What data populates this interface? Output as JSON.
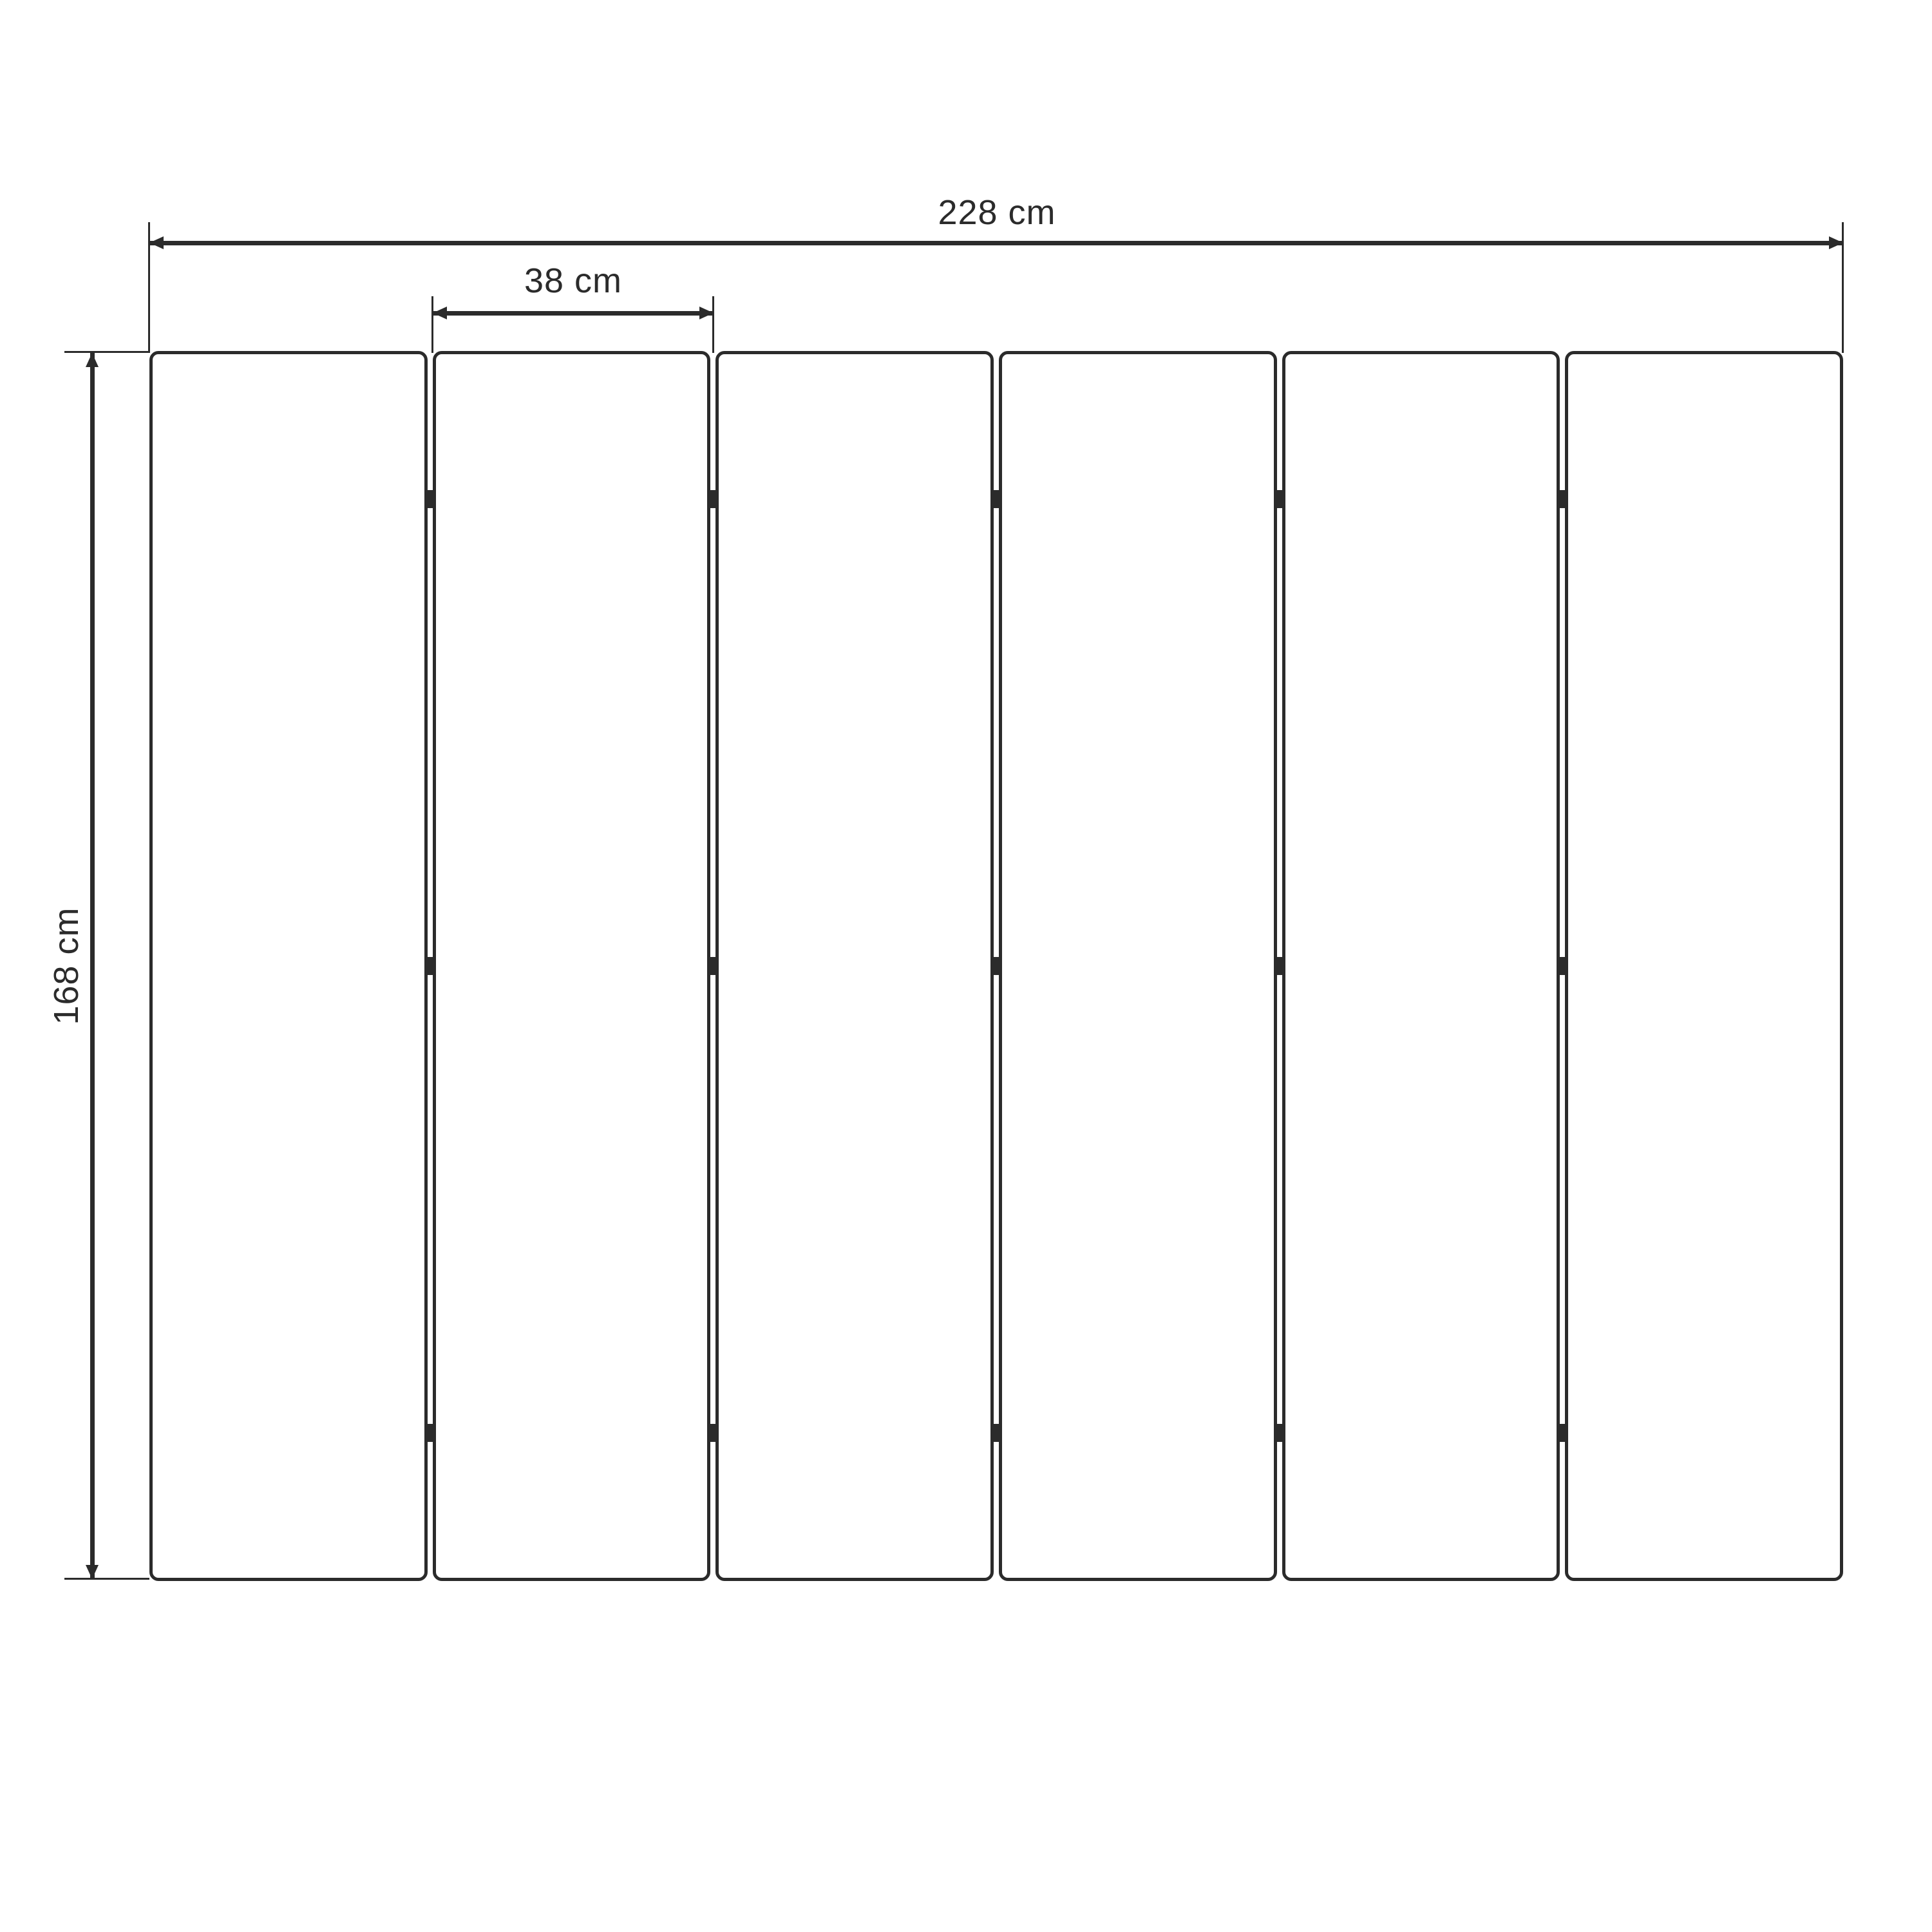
{
  "diagram": {
    "panels": {
      "count": 6,
      "hinge_rows": 3
    },
    "dimensions": {
      "total_width": {
        "label": "228 cm",
        "value": 228,
        "unit": "cm"
      },
      "panel_width": {
        "label": "38 cm",
        "value": 38,
        "unit": "cm"
      },
      "height": {
        "label": "168 cm",
        "value": 168,
        "unit": "cm"
      }
    },
    "colors": {
      "line": "#2b2b2b",
      "background": "#ffffff",
      "panel_fill": "#ffffff"
    }
  }
}
